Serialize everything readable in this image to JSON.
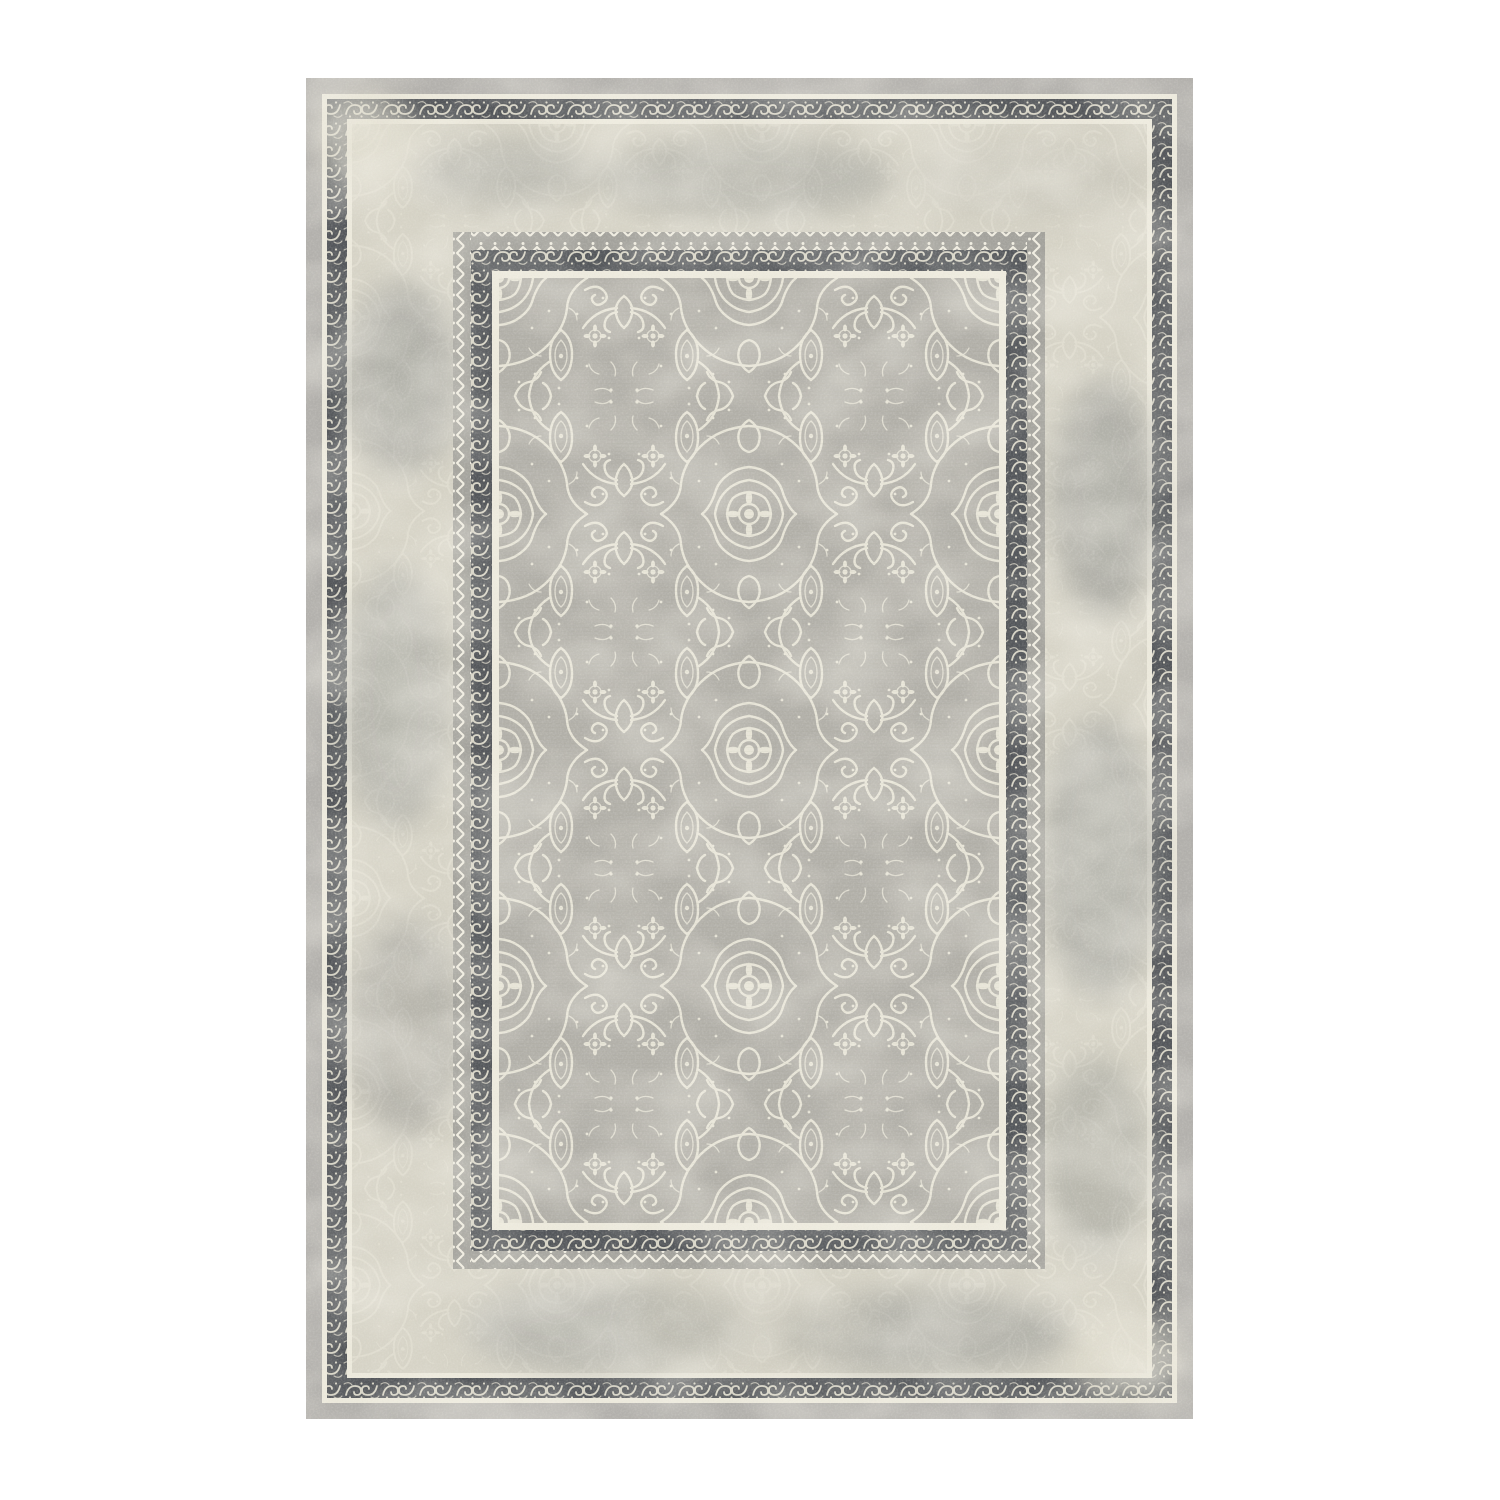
{
  "image": {
    "type": "product-photo",
    "subject": "distressed vintage oriental area rug, portrait orientation, centered on plain white background"
  },
  "colors": {
    "page_background": "#ffffff",
    "outer_plain_band": "#b3b1ad",
    "cream_line": "#edeadd",
    "dark_border_background": "#53565a",
    "border_ornament_cream": "#d8d5c7",
    "distressed_field_base": "#d7d4c7",
    "distressed_ornament_gray": "#9a9c93",
    "distressed_smudge_dark": "#8e908d",
    "distressed_smudge_mid": "#9b9d99",
    "distressed_smudge_light": "#c5c3b7",
    "zigzag_band_background": "#a3a29c",
    "zigzag_line_cream": "#f1eee2",
    "inner_field_background": "#b2b0a9",
    "inner_pattern_cream": "#e8e5d8"
  },
  "rug": {
    "orientation": "portrait",
    "sections": [
      {
        "name": "outer-plain-band"
      },
      {
        "name": "outer-cream-line"
      },
      {
        "name": "outer-ornate-dark-border"
      },
      {
        "name": "inner-cream-line"
      },
      {
        "name": "distressed-outer-field"
      },
      {
        "name": "zigzag-trim"
      },
      {
        "name": "inner-ornate-dark-border"
      },
      {
        "name": "field-cream-line"
      },
      {
        "name": "inner-damask-field"
      }
    ]
  }
}
